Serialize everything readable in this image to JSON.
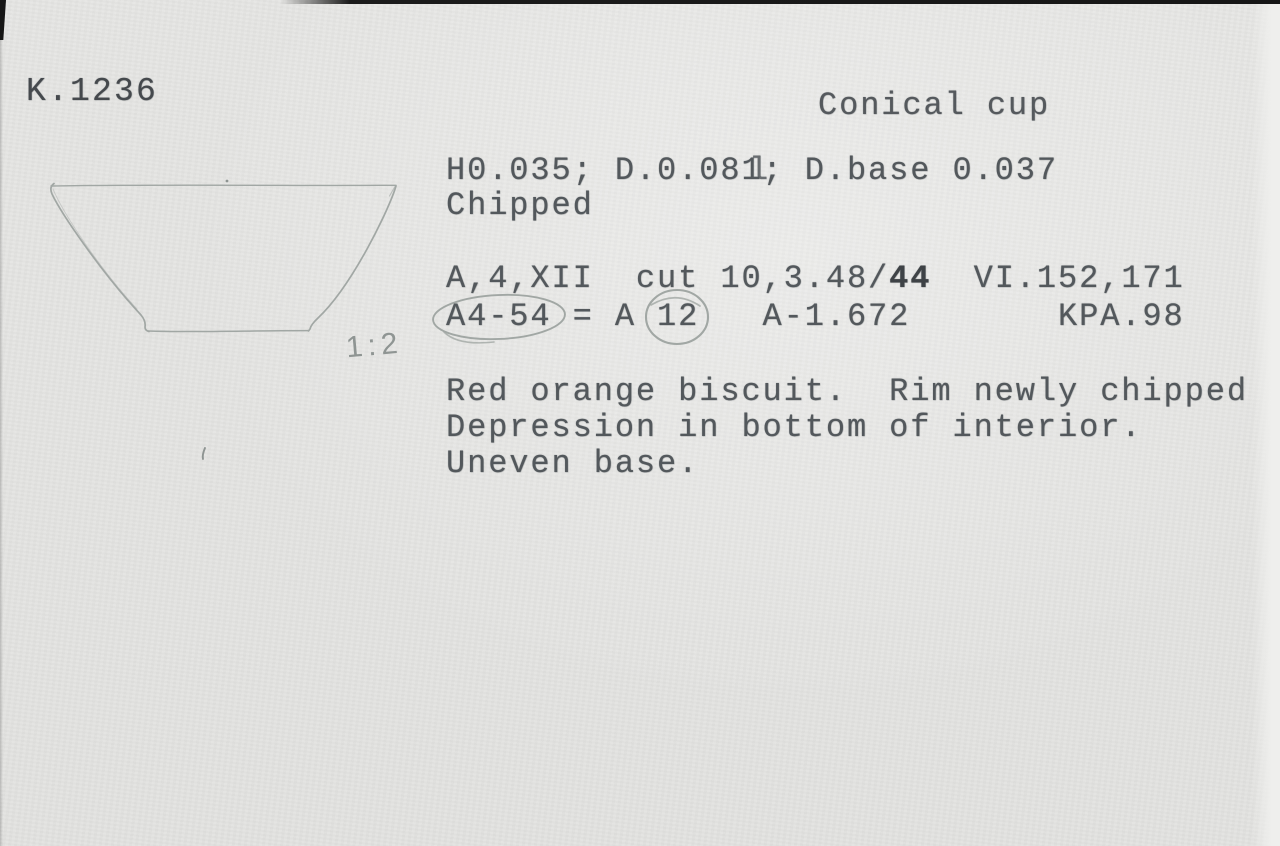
{
  "card": {
    "number": "K.1236",
    "title": "Conical cup",
    "dimensions": {
      "line1": "H0.035; D.0.081; D.base 0.037",
      "overstrike_mark": "l",
      "condition": "Chipped"
    },
    "context": {
      "line1_pre": "A,4,XII  cut 10,3.48/",
      "line1_bold": "44",
      "line1_post": "  VI.152,171",
      "line2": "A4-54 = A 12   A-1.672       KPA.98"
    },
    "description": {
      "line1": "Red orange biscuit.  Rim newly chipped",
      "line2": "Depression in bottom of interior.",
      "line3": "Uneven base."
    },
    "annotations": {
      "scale": "1:2"
    },
    "colors": {
      "paper": "#e4e4e2",
      "ink": "#53585c",
      "pencil": "#a1a7a4",
      "scan_edge": "#1b1b1b"
    }
  }
}
